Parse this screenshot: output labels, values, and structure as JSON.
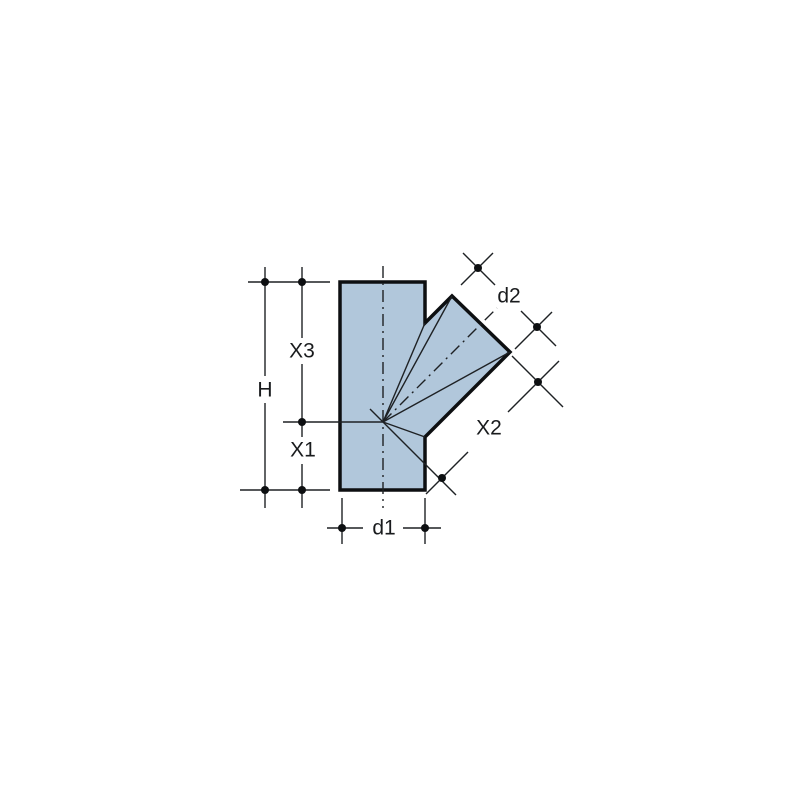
{
  "diagram": {
    "type": "technical-dimension-drawing",
    "subject": "45-degree branch pipe fitting",
    "labels": {
      "total_height": "H",
      "top_to_center": "X3",
      "center_to_bottom": "X1",
      "branch_length": "X2",
      "main_diameter": "d1",
      "branch_diameter": "d2"
    },
    "colors": {
      "background": "#ffffff",
      "fitting_fill": "#b1c7db",
      "outline": "#0d0f11",
      "thin_line": "#1e2124",
      "text": "#191b1d"
    }
  }
}
